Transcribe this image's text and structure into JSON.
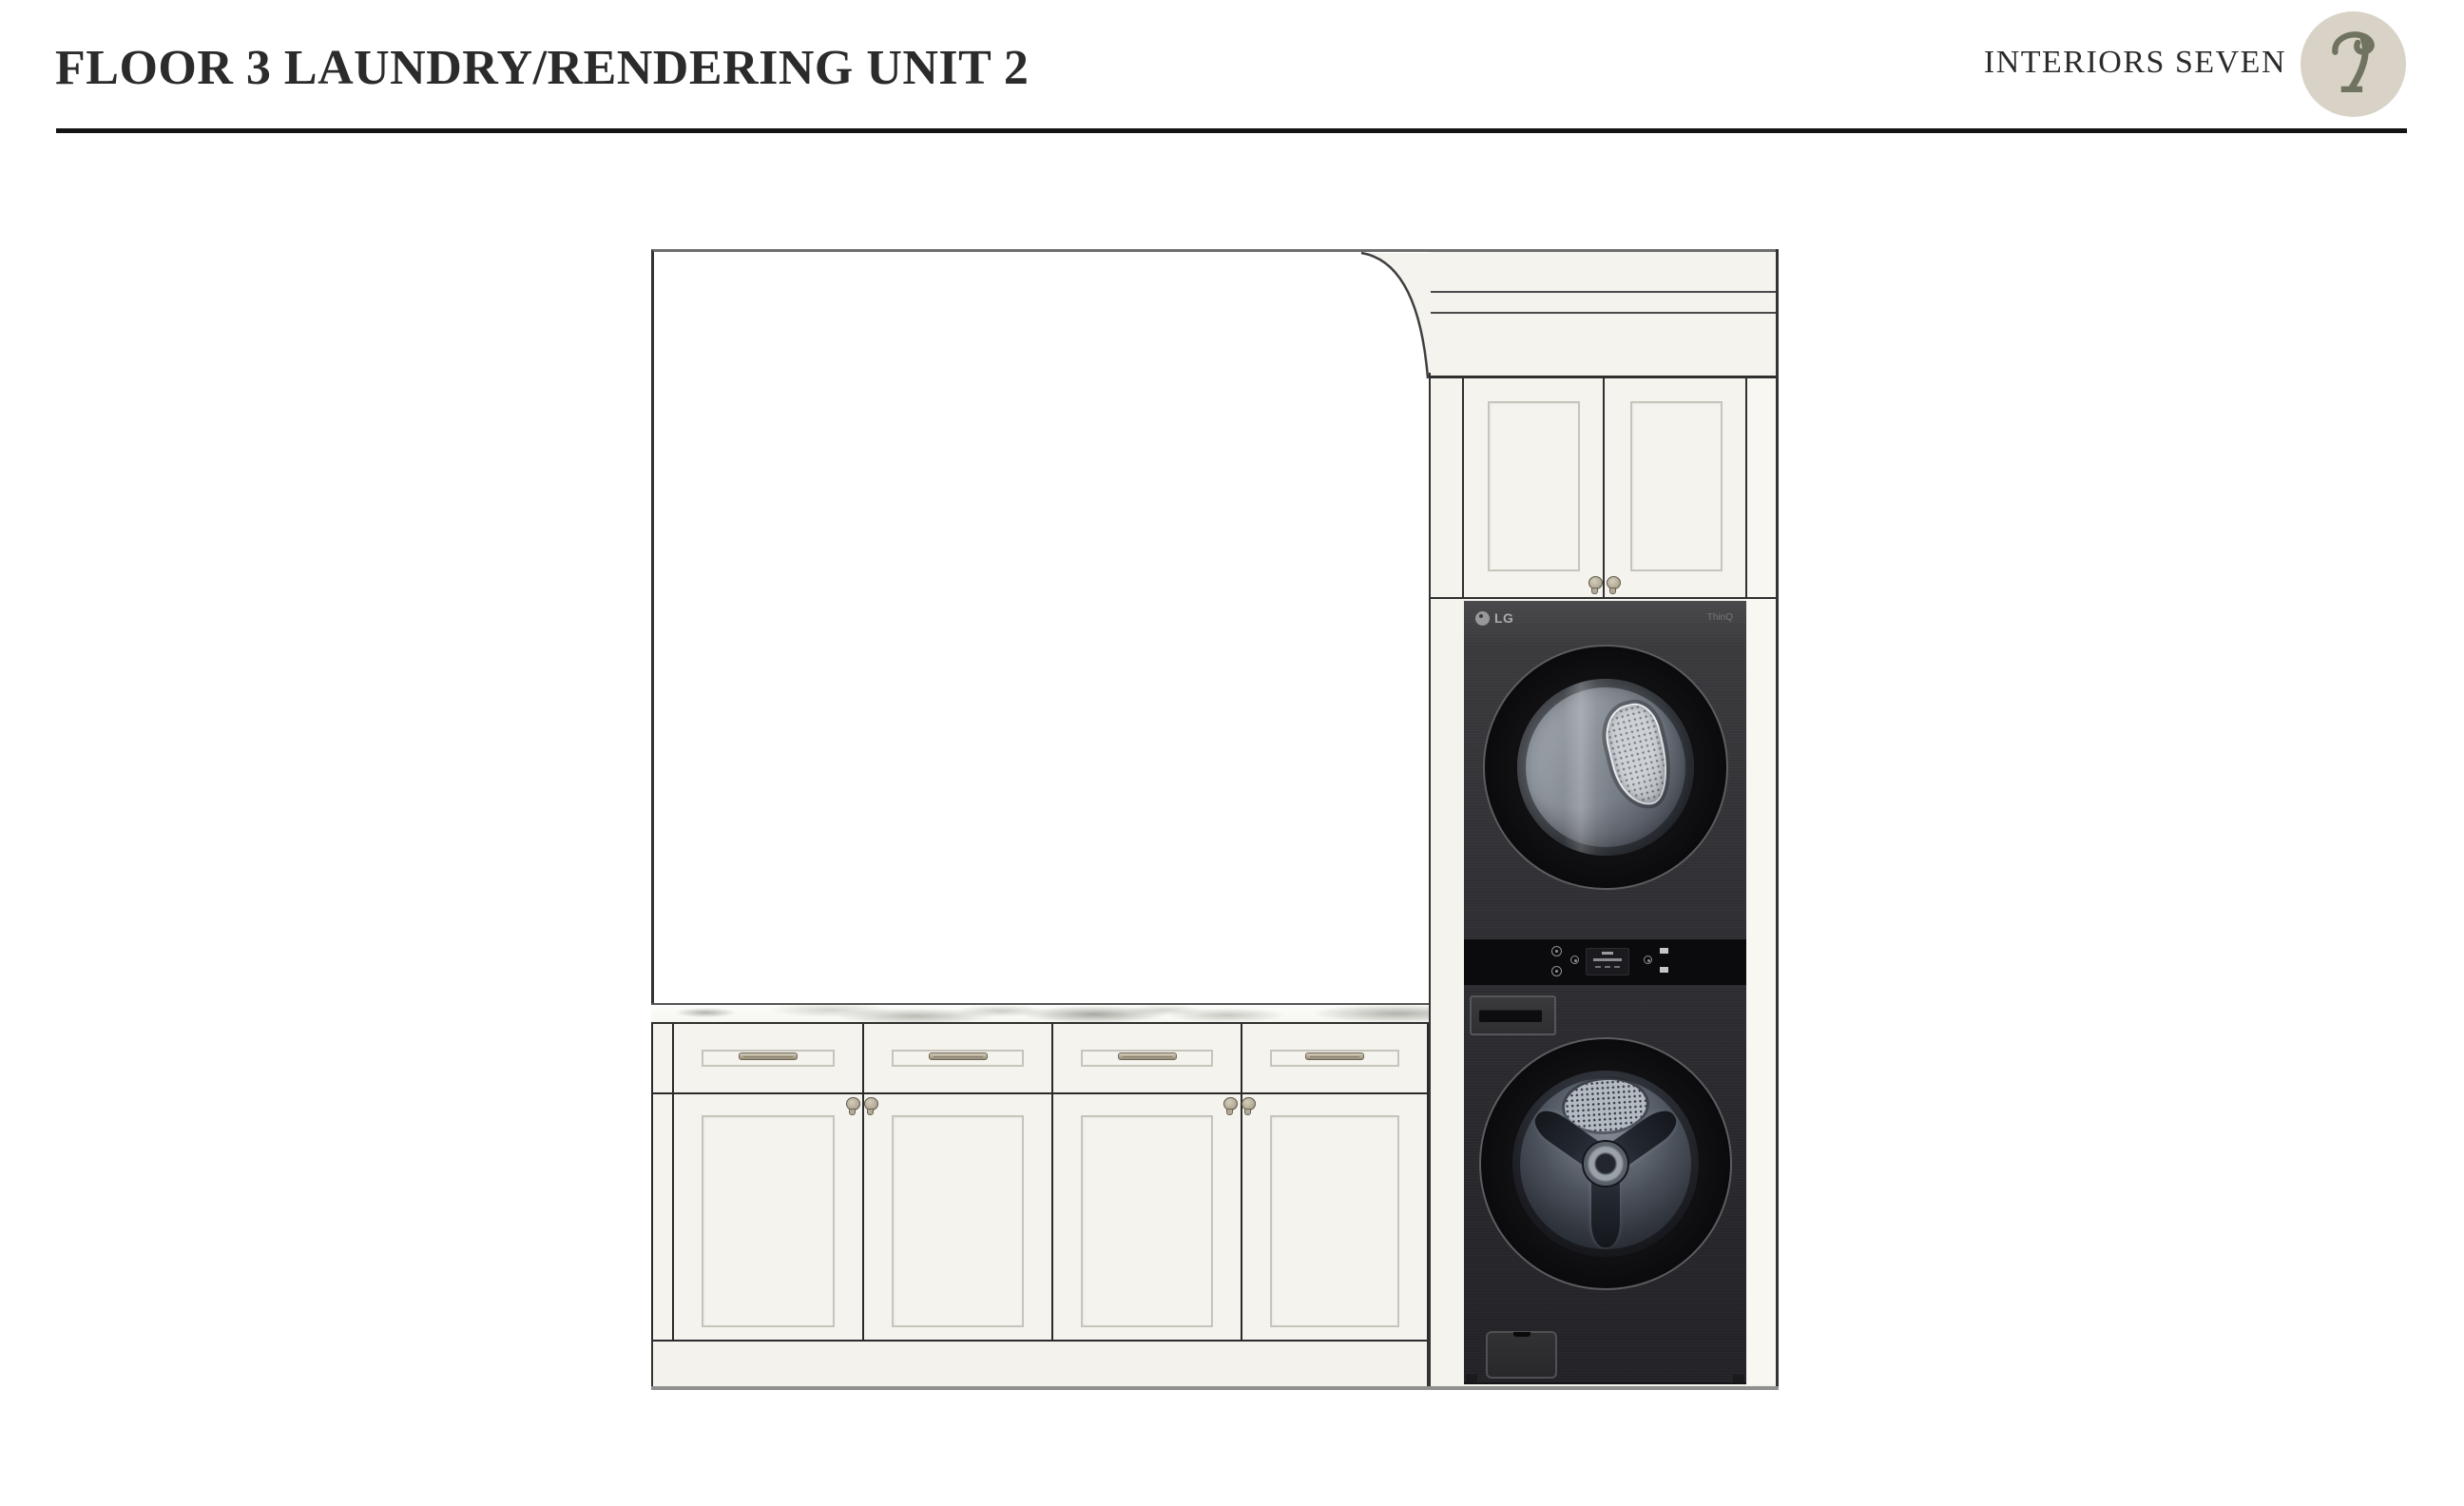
{
  "header": {
    "title": "FLOOR 3 LAUNDRY/RENDERING UNIT 2",
    "brand": "INTERIORS SEVEN",
    "logo_glyph": "stylized-i7-botanical-mark"
  },
  "appliance": {
    "brand_label": "LG",
    "smart_label": "ThinQ",
    "type": "stacked washtower (dryer above, washer below)"
  },
  "cabinets": {
    "base_bay_count": 4,
    "base_bay_parts": [
      "drawer front with bar pull",
      "shaker door with knob"
    ],
    "base_knob_pairs": 2,
    "upper_door_count": 2,
    "upper_knob_pairs": 1,
    "counter_material": "white marble with gray veining"
  },
  "colors": {
    "ink": "#2b2b2b",
    "cabinet_cream": "#f4f3ee",
    "marble": "#fcfcfa",
    "appliance": "#323236",
    "panel": "#0b0b0d",
    "drum": "#7f858d",
    "hardware": "#b3aa96",
    "logo_circle": "#d9d3c7",
    "logo_glyph_color": "#70735f"
  }
}
